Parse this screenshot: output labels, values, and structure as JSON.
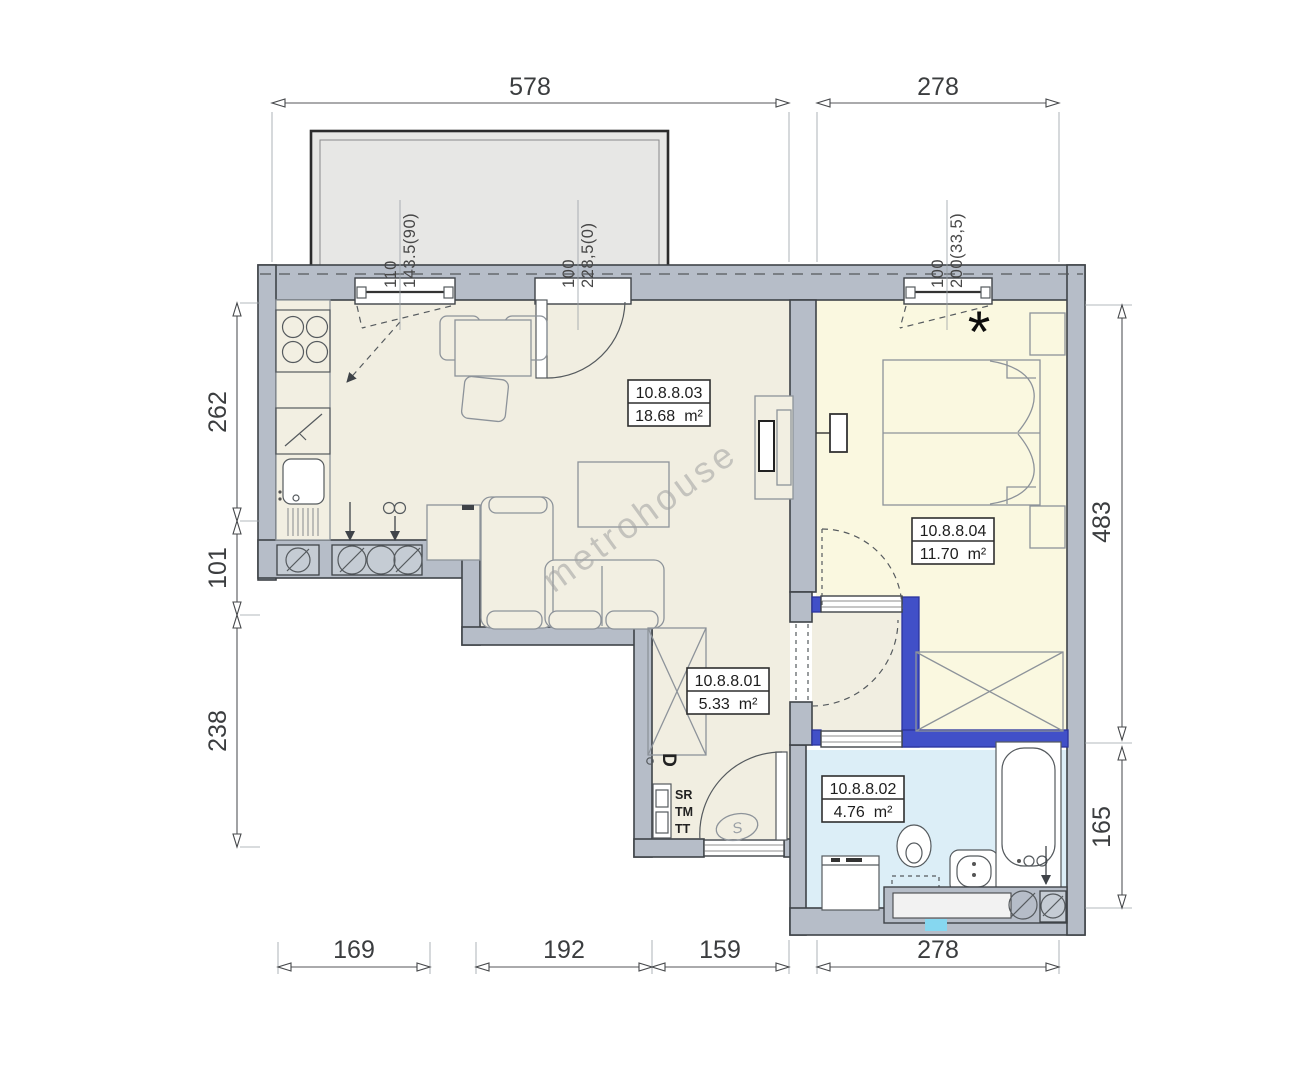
{
  "dims": {
    "top": [
      "578",
      "278"
    ],
    "bottom": [
      "169",
      "192",
      "159",
      "278"
    ],
    "left": [
      "262",
      "101",
      "238"
    ],
    "right": [
      "483",
      "165"
    ]
  },
  "openings": [
    {
      "w": "110",
      "sill": "143.5(90)"
    },
    {
      "w": "100",
      "sill": "228,5(0)"
    },
    {
      "w": "100",
      "sill": "200(33,5)"
    }
  ],
  "rooms": [
    {
      "id": "10.8.8.03",
      "area": "18.68",
      "unit": "m²"
    },
    {
      "id": "10.8.8.04",
      "area": "11.70",
      "unit": "m²"
    },
    {
      "id": "10.8.8.01",
      "area": "5.33",
      "unit": "m²"
    },
    {
      "id": "10.8.8.02",
      "area": "4.76",
      "unit": "m²"
    }
  ],
  "annotations": {
    "asterisk": "*",
    "door_letter": "D",
    "door_closer": "S",
    "meters": [
      "SR",
      "TM",
      "TT"
    ],
    "watermark": "metrohouse"
  },
  "colors": {
    "wall": "#b6bdc8",
    "wall_outline": "#3f4348",
    "accent_wall": "#4150c8",
    "floor_main": "#f1eee1",
    "floor_bedroom": "#faf8e0",
    "floor_bathroom": "#dceef7",
    "balcony": "#e7e7e5",
    "marker": "#86d7f0"
  }
}
